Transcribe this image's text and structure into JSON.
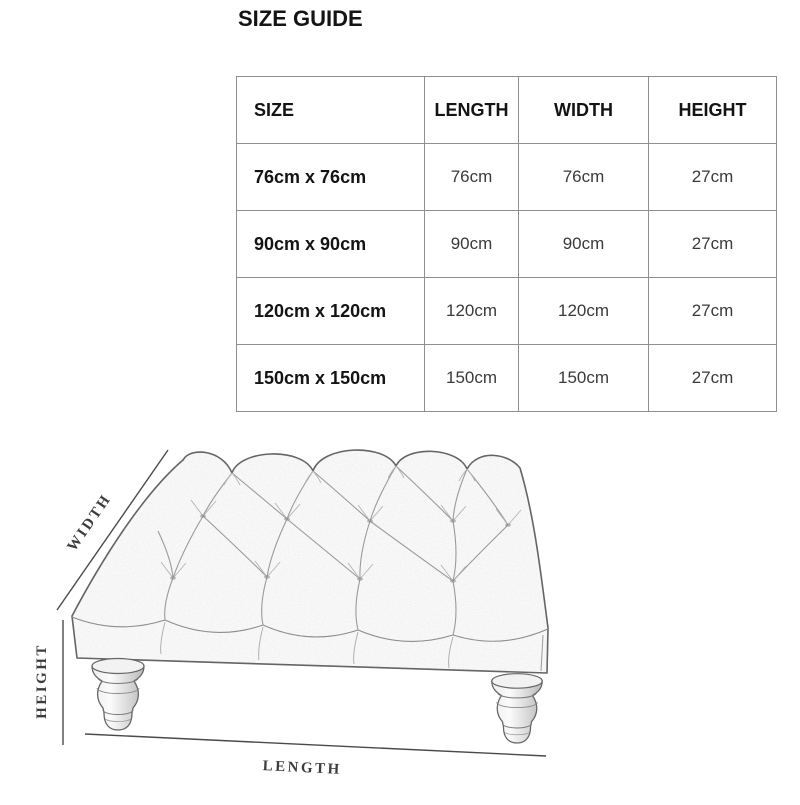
{
  "title": "SIZE GUIDE",
  "table": {
    "columns": [
      "SIZE",
      "LENGTH",
      "WIDTH",
      "HEIGHT"
    ],
    "column_keys": [
      "size",
      "length",
      "width",
      "height"
    ],
    "rows": [
      [
        "76cm x 76cm",
        "76cm",
        "76cm",
        "27cm"
      ],
      [
        "90cm x 90cm",
        "90cm",
        "90cm",
        "27cm"
      ],
      [
        "120cm x 120cm",
        "120cm",
        "120cm",
        "27cm"
      ],
      [
        "150cm x 150cm",
        "150cm",
        "150cm",
        "27cm"
      ]
    ]
  },
  "diagram": {
    "width_label": "WIDTH",
    "height_label": "HEIGHT",
    "length_label": "LENGTH",
    "subject": "tufted-ottoman-footstool-sketch"
  },
  "colors": {
    "heading_text": "#141414",
    "value_text": "#3a3a3a",
    "table_border": "#8f8f8f",
    "sketch_outline": "#5d5d5d",
    "sketch_detail": "#9a9a9a",
    "dimension_line": "#4a4a4a",
    "background": "#ffffff"
  }
}
